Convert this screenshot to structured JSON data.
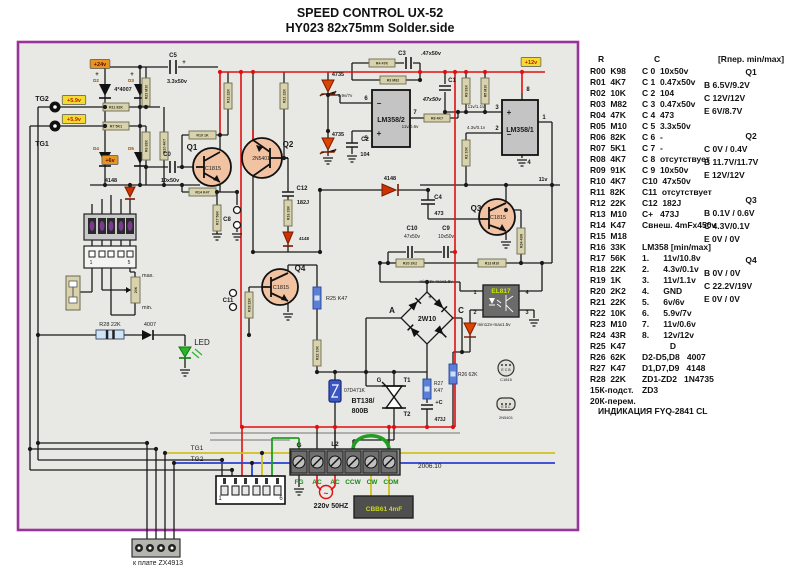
{
  "title": {
    "line1": "SPEED CONTROL UX-52",
    "line2": "HY023  82x75mm  Solder.side"
  },
  "parts_panel": {
    "r_header": "R",
    "c_header": "C",
    "q_header": "[Rпер. min/max]",
    "r_rows": [
      "R00  K98",
      "R01  4K7",
      "R02  10K",
      "R03  M82",
      "R04  47K",
      "R05  M10",
      "R06  82K",
      "R07  5K1",
      "R08  4K7",
      "R09  91K",
      "R10  4K7",
      "R11  82K",
      "R12  22K",
      "R13  M10",
      "R14  K47",
      "R15  M18",
      "R16  33K",
      "R17  56K",
      "R18  22K",
      "R19  1K",
      "R20  2K2",
      "R21  22K",
      "R22  10K",
      "R23  M10",
      "R24  43R",
      "R25  K47",
      "R26  62K",
      "R27  K47",
      "R28  22K",
      "15К-подст.",
      "20К-перем."
    ],
    "c_rows": [
      {
        "t": "C 0  10x50v"
      },
      {
        "t": "C 1  0.47x50v"
      },
      {
        "t": "C 2  104"
      },
      {
        "t": "C 3  0.47x50v"
      },
      {
        "t": "C 4  473"
      },
      {
        "t": "C 5  3.3x50v"
      },
      {
        "t": "C 6  -"
      },
      {
        "t": "C 7  -"
      },
      {
        "t": "C 8  отсутствует"
      },
      {
        "t": "C 9  10x50v"
      },
      {
        "t": "C10  47x50v"
      },
      {
        "t": "C11  отсутствует"
      },
      {
        "t": "C12  182J"
      },
      {
        "t": "C+   473J"
      },
      {
        "t": "Свнеш. 4mFx450v"
      },
      {
        "t": ""
      },
      {
        "t": "LM358 [min/max]"
      },
      {
        "t": "1.      11v/10.8v"
      },
      {
        "t": "2.      4.3v/0.1v"
      },
      {
        "t": "3.      11v/1.1v"
      },
      {
        "t": "4.      GND"
      },
      {
        "t": "5.      6v/6v"
      },
      {
        "t": "6.      5.9v/7v"
      },
      {
        "t": "7.      11v/0.6v"
      },
      {
        "t": "8.      12v/12v"
      },
      {
        "t": "D",
        "c": 1
      },
      {
        "t": "D2-D5,D8   4007"
      },
      {
        "t": "D1,D7,D9   4148"
      },
      {
        "t": "ZD1-ZD2   1N4735"
      },
      {
        "t": "ZD3"
      }
    ],
    "q_blocks": [
      {
        "name": "Q1",
        "lines": [
          "B  6.5V/9.2V",
          "C  12V/12V",
          "E  6V/8.7V"
        ]
      },
      {
        "name": "Q2",
        "lines": [
          "C  0V / 0.4V",
          "B  11.7V/11.7V",
          "E  12V/12V"
        ]
      },
      {
        "name": "Q3",
        "lines": [
          "B  0.1V / 0.6V",
          "C  4.3V/0.1V",
          "E  0V / 0V"
        ]
      },
      {
        "name": "Q4",
        "lines": [
          "B  0V / 0V",
          "C  22.2V/19V",
          "E  0V / 0V"
        ]
      }
    ],
    "footer": "ИНДИКАЦИЯ FYQ-2841 CL"
  },
  "schematic": {
    "tags": [
      {
        "t": "+24v",
        "x": 100,
        "y": 64,
        "bg": "#e89420",
        "fg": "#5a1000"
      },
      {
        "t": "+5.9v",
        "x": 74,
        "y": 100,
        "bg": "#f2dc30",
        "fg": "#c41800"
      },
      {
        "t": "+5.9v",
        "x": 74,
        "y": 119,
        "bg": "#f2dc30",
        "fg": "#c41800"
      },
      {
        "t": "+6v",
        "x": 110,
        "y": 160,
        "bg": "#e89420",
        "fg": "#5a1000"
      },
      {
        "t": "+12v",
        "x": 531,
        "y": 62,
        "bg": "#f2dc30",
        "fg": "#c41800"
      }
    ],
    "resistors": [
      {
        "x": 103,
        "y": 103,
        "w": 26,
        "h": 8,
        "l": "R11 82K"
      },
      {
        "x": 103,
        "y": 122,
        "w": 26,
        "h": 8,
        "l": "R7 5K1"
      },
      {
        "x": 189,
        "y": 131,
        "w": 27,
        "h": 8,
        "l": "R19 1K"
      },
      {
        "x": 189,
        "y": 188,
        "w": 27,
        "h": 8,
        "l": "R14 K47"
      },
      {
        "x": 369,
        "y": 59,
        "w": 26,
        "h": 8,
        "l": "R4 47K"
      },
      {
        "x": 380,
        "y": 76,
        "w": 26,
        "h": 8,
        "l": "R3 M82"
      },
      {
        "x": 424,
        "y": 114,
        "w": 26,
        "h": 8,
        "l": "R8 4K7"
      },
      {
        "x": 396,
        "y": 259,
        "w": 28,
        "h": 8,
        "l": "R20 2K2"
      },
      {
        "x": 478,
        "y": 259,
        "w": 28,
        "h": 8,
        "l": "R13 M10"
      },
      {
        "x": 142,
        "y": 78,
        "w": 8,
        "h": 28,
        "l": "R23 M10",
        "v": 1
      },
      {
        "x": 142,
        "y": 132,
        "w": 8,
        "h": 28,
        "l": "R6 82K",
        "v": 1
      },
      {
        "x": 160,
        "y": 132,
        "w": 8,
        "h": 28,
        "l": "R10 4K7",
        "v": 1
      },
      {
        "x": 224,
        "y": 83,
        "w": 8,
        "h": 26,
        "l": "R12 22K",
        "v": 1
      },
      {
        "x": 280,
        "y": 83,
        "w": 8,
        "h": 26,
        "l": "R21 22K",
        "v": 1
      },
      {
        "x": 213,
        "y": 205,
        "w": 8,
        "h": 26,
        "l": "R17 56K",
        "v": 1
      },
      {
        "x": 284,
        "y": 200,
        "w": 8,
        "h": 26,
        "l": "R16 33K",
        "v": 1
      },
      {
        "x": 245,
        "y": 292,
        "w": 8,
        "h": 26,
        "l": "R18 22K",
        "v": 1
      },
      {
        "x": 313,
        "y": 340,
        "w": 8,
        "h": 26,
        "l": "R22 10K",
        "v": 1
      },
      {
        "x": 462,
        "y": 78,
        "w": 8,
        "h": 26,
        "l": "R9 91K",
        "v": 1
      },
      {
        "x": 481,
        "y": 78,
        "w": 8,
        "h": 26,
        "l": "R5 M10",
        "v": 1
      },
      {
        "x": 462,
        "y": 140,
        "w": 8,
        "h": 26,
        "l": "R2 10K",
        "v": 1
      },
      {
        "x": 517,
        "y": 228,
        "w": 8,
        "h": 26,
        "l": "R24 43R",
        "v": 1
      },
      {
        "x": 131,
        "y": 277,
        "w": 9,
        "h": 26,
        "l": "20K",
        "v": 1
      },
      {
        "x": 313,
        "y": 287,
        "w": 8,
        "h": 22,
        "blue": 1,
        "v": 1
      },
      {
        "x": 449,
        "y": 364,
        "w": 8,
        "h": 20,
        "blue": 1,
        "v": 1
      },
      {
        "x": 423,
        "y": 379,
        "w": 8,
        "h": 20,
        "blue": 1,
        "v": 1
      },
      {
        "x": 96,
        "y": 330,
        "w": 28,
        "h": 9,
        "blue": 1,
        "band": 1
      }
    ],
    "labels": [
      {
        "t": "TG2",
        "x": 42,
        "y": 101,
        "s": 7,
        "b": 1
      },
      {
        "t": "TG1",
        "x": 42,
        "y": 146,
        "s": 7,
        "b": 1
      },
      {
        "t": "4*4007",
        "x": 123,
        "y": 91,
        "s": 5.5,
        "b": 1
      },
      {
        "t": "D2",
        "x": 96,
        "y": 82,
        "s": 4.5,
        "b": 1,
        "c": "#8a4a00"
      },
      {
        "t": "D3",
        "x": 131,
        "y": 82,
        "s": 4.5,
        "b": 1,
        "c": "#8a4a00"
      },
      {
        "t": "D4",
        "x": 96,
        "y": 150,
        "s": 4.5,
        "b": 1,
        "c": "#8a4a00"
      },
      {
        "t": "D5",
        "x": 131,
        "y": 150,
        "s": 4.5,
        "b": 1,
        "c": "#8a4a00"
      },
      {
        "t": "+",
        "x": 97,
        "y": 76,
        "s": 6,
        "b": 1
      },
      {
        "t": "+",
        "x": 132,
        "y": 76,
        "s": 6,
        "b": 1
      },
      {
        "t": "C5",
        "x": 173,
        "y": 57,
        "s": 6,
        "b": 1
      },
      {
        "t": "+",
        "x": 184,
        "y": 64,
        "s": 6,
        "b": 1
      },
      {
        "t": "3.3x50v",
        "x": 177,
        "y": 83,
        "s": 5.5,
        "b": 1
      },
      {
        "t": "4148",
        "x": 111,
        "y": 182,
        "s": 5.5,
        "b": 1
      },
      {
        "t": "C0",
        "x": 167,
        "y": 156,
        "s": 6,
        "b": 1
      },
      {
        "t": "10x50v",
        "x": 170,
        "y": 182,
        "s": 5.5,
        "b": 1
      },
      {
        "t": "Q1",
        "x": 192,
        "y": 150,
        "s": 8,
        "b": 1
      },
      {
        "t": "C1815",
        "x": 213,
        "y": 170,
        "s": 5.5
      },
      {
        "t": "Q2",
        "x": 288,
        "y": 147,
        "s": 8,
        "b": 1
      },
      {
        "t": "2N5401",
        "x": 261,
        "y": 160,
        "s": 5
      },
      {
        "t": "C12",
        "x": 302,
        "y": 190,
        "s": 6,
        "b": 1
      },
      {
        "t": "182J",
        "x": 303,
        "y": 204,
        "s": 5.5,
        "b": 1
      },
      {
        "t": "4148",
        "x": 304,
        "y": 240,
        "s": 4.5,
        "b": 1
      },
      {
        "t": "4735",
        "x": 338,
        "y": 76,
        "s": 5.5,
        "b": 1
      },
      {
        "t": "4735",
        "x": 338,
        "y": 136,
        "s": 5.5,
        "b": 1
      },
      {
        "t": "C2",
        "x": 365,
        "y": 141,
        "s": 6,
        "b": 1
      },
      {
        "t": "104",
        "x": 365,
        "y": 156,
        "s": 5.5,
        "b": 1
      },
      {
        "t": "C3",
        "x": 402,
        "y": 55,
        "s": 6,
        "b": 1
      },
      {
        "t": ".47x50v",
        "x": 431,
        "y": 55,
        "s": 5.5,
        "b": 1
      },
      {
        "t": "C1",
        "x": 452,
        "y": 82,
        "s": 6,
        "b": 1
      },
      {
        "t": "47x50v",
        "x": 432,
        "y": 101,
        "s": 5.5,
        "b": 1,
        "i": 1
      },
      {
        "t": "LM358/2",
        "x": 391,
        "y": 122,
        "s": 7,
        "b": 1
      },
      {
        "t": "LM358/1",
        "x": 520,
        "y": 132,
        "s": 7,
        "b": 1
      },
      {
        "t": "6",
        "x": 366,
        "y": 100,
        "s": 6,
        "b": 1
      },
      {
        "t": "5",
        "x": 366,
        "y": 140,
        "s": 6,
        "b": 1
      },
      {
        "t": "7",
        "x": 415,
        "y": 114,
        "s": 6,
        "b": 1
      },
      {
        "t": "8",
        "x": 528,
        "y": 91,
        "s": 6,
        "b": 1
      },
      {
        "t": "3",
        "x": 497,
        "y": 109,
        "s": 6,
        "b": 1
      },
      {
        "t": "2",
        "x": 497,
        "y": 130,
        "s": 6,
        "b": 1
      },
      {
        "t": "1",
        "x": 544,
        "y": 119,
        "s": 6,
        "b": 1
      },
      {
        "t": "4",
        "x": 529,
        "y": 164,
        "s": 6,
        "b": 1
      },
      {
        "t": "−",
        "x": 379,
        "y": 106,
        "s": 8,
        "b": 1
      },
      {
        "t": "+",
        "x": 379,
        "y": 136,
        "s": 8,
        "b": 1
      },
      {
        "t": "+",
        "x": 509,
        "y": 115,
        "s": 8,
        "b": 1
      },
      {
        "t": "−",
        "x": 509,
        "y": 137,
        "s": 8,
        "b": 1
      },
      {
        "t": "5.9v/7v",
        "x": 345,
        "y": 97,
        "s": 4.5
      },
      {
        "t": "11v/1.1v",
        "x": 476,
        "y": 108,
        "s": 4.5
      },
      {
        "t": "4.3v/0.1v",
        "x": 476,
        "y": 129,
        "s": 4.5
      },
      {
        "t": "11v/0.6v",
        "x": 410,
        "y": 128,
        "s": 4.5
      },
      {
        "t": "11v",
        "x": 543,
        "y": 181,
        "s": 5.5,
        "b": 1
      },
      {
        "t": "Q3",
        "x": 476,
        "y": 211,
        "s": 8,
        "b": 1
      },
      {
        "t": "C1815",
        "x": 498,
        "y": 219,
        "s": 5.5
      },
      {
        "t": "C4",
        "x": 438,
        "y": 199,
        "s": 6,
        "b": 1
      },
      {
        "t": "473",
        "x": 439,
        "y": 215,
        "s": 5.5,
        "b": 1
      },
      {
        "t": "4148",
        "x": 390,
        "y": 180,
        "s": 5.5,
        "b": 1
      },
      {
        "t": "C10",
        "x": 412,
        "y": 230,
        "s": 6,
        "b": 1
      },
      {
        "t": "47x50v",
        "x": 412,
        "y": 238,
        "s": 5
      },
      {
        "t": "C9",
        "x": 446,
        "y": 230,
        "s": 6,
        "b": 1
      },
      {
        "t": "10x50v",
        "x": 446,
        "y": 238,
        "s": 5
      },
      {
        "t": "Q4",
        "x": 300,
        "y": 271,
        "s": 8,
        "b": 1
      },
      {
        "t": "C1815",
        "x": 281,
        "y": 289,
        "s": 5.5
      },
      {
        "t": "C11",
        "x": 228,
        "y": 302,
        "s": 6,
        "b": 1
      },
      {
        "t": "C8",
        "x": 227,
        "y": 221,
        "s": 6,
        "b": 1
      },
      {
        "t": "R25 K47",
        "x": 326,
        "y": 300,
        "s": 5.5,
        "a": "s"
      },
      {
        "t": "A",
        "x": 392,
        "y": 313,
        "s": 8,
        "b": 1
      },
      {
        "t": "C",
        "x": 461,
        "y": 313,
        "s": 8,
        "b": 1
      },
      {
        "t": "2W10",
        "x": 427,
        "y": 321,
        "s": 7,
        "b": 1
      },
      {
        "t": "+",
        "x": 430,
        "y": 299,
        "s": 6,
        "b": 1
      },
      {
        "t": "min13v-max1.8v",
        "x": 436,
        "y": 283,
        "s": 4.5
      },
      {
        "t": "min12v-max1.5v",
        "x": 494,
        "y": 326,
        "s": 4.5
      },
      {
        "t": "EL817",
        "x": 501,
        "y": 293,
        "s": 6.5,
        "b": 1,
        "c": "#c8e400"
      },
      {
        "t": "1",
        "x": 475,
        "y": 294,
        "s": 5.5,
        "b": 1
      },
      {
        "t": "2",
        "x": 475,
        "y": 314,
        "s": 5.5,
        "b": 1
      },
      {
        "t": "4",
        "x": 527,
        "y": 294,
        "s": 5.5,
        "b": 1
      },
      {
        "t": "3",
        "x": 527,
        "y": 314,
        "s": 5.5,
        "b": 1
      },
      {
        "t": "R26 62K",
        "x": 458,
        "y": 376,
        "s": 5,
        "a": "s"
      },
      {
        "t": "R27",
        "x": 434,
        "y": 385,
        "s": 5,
        "a": "s"
      },
      {
        "t": "K47",
        "x": 434,
        "y": 392,
        "s": 5,
        "a": "s"
      },
      {
        "t": "+C",
        "x": 439,
        "y": 404,
        "s": 5.5,
        "b": 1
      },
      {
        "t": "473J",
        "x": 440,
        "y": 421,
        "s": 5,
        "b": 1
      },
      {
        "t": "07D471K",
        "x": 344,
        "y": 392,
        "s": 5,
        "a": "s"
      },
      {
        "t": "G",
        "x": 379,
        "y": 382,
        "s": 6,
        "b": 1
      },
      {
        "t": "T1",
        "x": 407,
        "y": 382,
        "s": 6,
        "b": 1
      },
      {
        "t": "T2",
        "x": 407,
        "y": 416,
        "s": 6,
        "b": 1
      },
      {
        "t": "BT138/",
        "x": 363,
        "y": 403,
        "s": 7,
        "b": 1
      },
      {
        "t": "800B",
        "x": 360,
        "y": 413,
        "s": 7,
        "b": 1
      },
      {
        "t": "G",
        "x": 299,
        "y": 447,
        "s": 6.5,
        "b": 1
      },
      {
        "t": "L2",
        "x": 335,
        "y": 446,
        "s": 6.5,
        "b": 1
      },
      {
        "t": "FG",
        "x": 299,
        "y": 484,
        "s": 6.5,
        "b": 1,
        "c": "#1a8a1a"
      },
      {
        "t": "AC",
        "x": 317,
        "y": 484,
        "s": 6.5,
        "b": 1,
        "c": "#1a8a1a"
      },
      {
        "t": "AC",
        "x": 335,
        "y": 484,
        "s": 6.5,
        "b": 1,
        "c": "#1a8a1a"
      },
      {
        "t": "CCW",
        "x": 353,
        "y": 484,
        "s": 6.5,
        "b": 1,
        "c": "#1a8a1a"
      },
      {
        "t": "CW",
        "x": 372,
        "y": 484,
        "s": 6.5,
        "b": 1,
        "c": "#1a8a1a"
      },
      {
        "t": "COM",
        "x": 391,
        "y": 484,
        "s": 6.5,
        "b": 1,
        "c": "#1a8a1a"
      },
      {
        "t": "2006.10",
        "x": 418,
        "y": 468,
        "s": 6.5,
        "a": "s"
      },
      {
        "t": "~",
        "x": 326,
        "y": 496,
        "s": 8,
        "b": 1,
        "c": "#cc1111"
      },
      {
        "t": "220v 50HZ",
        "x": 331,
        "y": 508,
        "s": 7,
        "b": 1
      },
      {
        "t": "CBB61 4mF",
        "x": 384,
        "y": 511,
        "s": 6.5,
        "b": 1,
        "c": "#c8d820"
      },
      {
        "t": "TG1",
        "x": 197,
        "y": 450,
        "s": 6.5
      },
      {
        "t": "TG2",
        "x": 197,
        "y": 461,
        "s": 6.5
      },
      {
        "t": "к плате ZX4913",
        "x": 158,
        "y": 565,
        "s": 7
      },
      {
        "t": "LED",
        "x": 202,
        "y": 345,
        "s": 8
      },
      {
        "t": "R28 22K",
        "x": 110,
        "y": 326,
        "s": 5.5
      },
      {
        "t": "4007",
        "x": 150,
        "y": 326,
        "s": 5.5
      },
      {
        "t": "max.",
        "x": 142,
        "y": 277,
        "s": 5.5,
        "a": "s"
      },
      {
        "t": "min.",
        "x": 142,
        "y": 309,
        "s": 5.5,
        "a": "s"
      },
      {
        "t": "1",
        "x": 220,
        "y": 500,
        "s": 6
      },
      {
        "t": "6",
        "x": 281,
        "y": 500,
        "s": 6
      },
      {
        "t": "1",
        "x": 91,
        "y": 264,
        "s": 5
      },
      {
        "t": "5",
        "x": 129,
        "y": 264,
        "s": 5
      },
      {
        "t": "E C B",
        "x": 506,
        "y": 371,
        "s": 3.5
      },
      {
        "t": "C1815",
        "x": 506,
        "y": 381,
        "s": 4
      },
      {
        "t": "E B C",
        "x": 506,
        "y": 408,
        "s": 3.5
      },
      {
        "t": "2N5401",
        "x": 506,
        "y": 419,
        "s": 4
      }
    ]
  }
}
